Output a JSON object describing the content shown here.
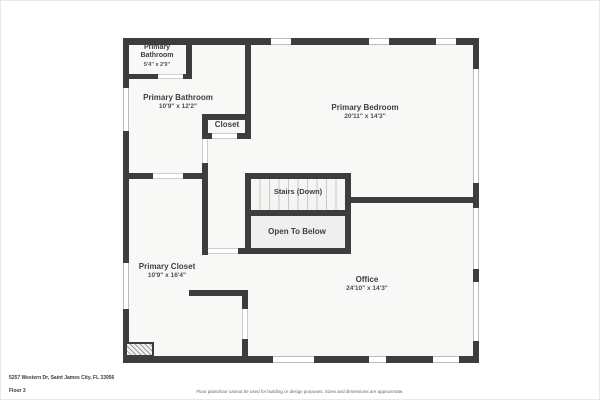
{
  "floorplan": {
    "rooms": [
      {
        "name": "Primary\nBathroom",
        "dims": "5'4\" x 2'9\""
      },
      {
        "name": "Primary Bathroom",
        "dims": "10'9\" x 12'2\""
      },
      {
        "name": "Closet",
        "dims": ""
      },
      {
        "name": "Primary Bedroom",
        "dims": "20'11\" x 14'3\""
      },
      {
        "name": "Stairs (Down)",
        "dims": ""
      },
      {
        "name": "Open To Below",
        "dims": ""
      },
      {
        "name": "Primary Closet",
        "dims": "10'9\" x 16'4\""
      },
      {
        "name": "Office",
        "dims": "24'10\" x 14'3\""
      }
    ]
  },
  "footer": {
    "address": "5257 Western Dr, Saint James City, FL 33956",
    "floor_label": "Floor 3",
    "disclaimer": "Floor plans/tour cannot be used for building or design purposes. Sizes and dimensions are approximate."
  },
  "colors": {
    "wall": "#3d3d3d",
    "room_fill": "#f8f8f7",
    "open_to_below_fill": "#efefee",
    "stair_tread_line": "#c9c9c9",
    "label_text": "#3a3f47",
    "dimension_text": "#4a505a",
    "disclaimer_text": "#666666"
  }
}
